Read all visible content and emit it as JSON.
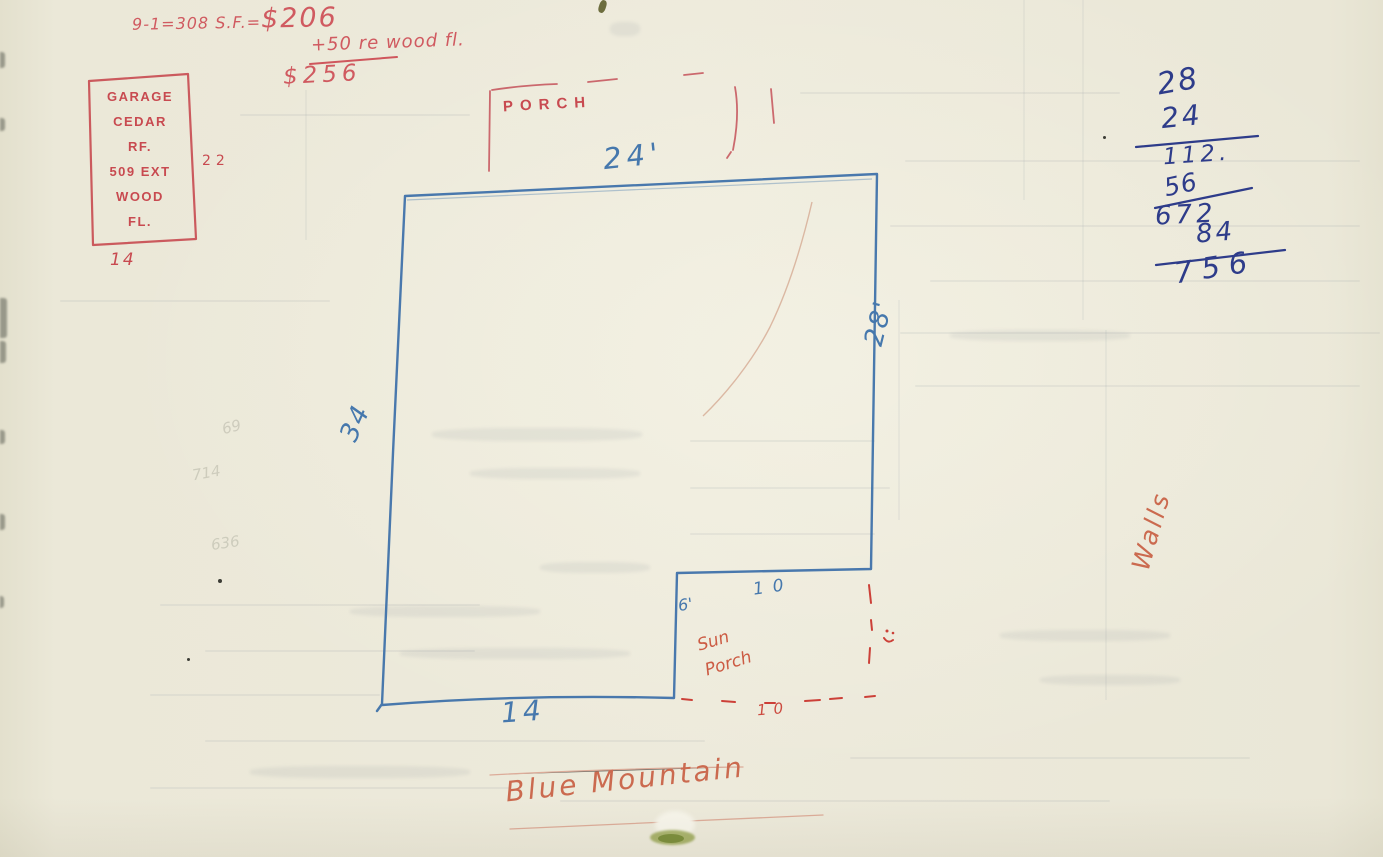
{
  "top_formula": {
    "equation_prefix": "9-1=308 S.F.=",
    "equation_value": "$206",
    "addition_line": "+50 re wood fl.",
    "total": "$256"
  },
  "garage_note": {
    "line1": "GARAGE",
    "line2": "CEDAR",
    "line3": "RF.",
    "line4": "509 EXT",
    "line5": "WOOD",
    "line6": "FL.",
    "width_dim": "22",
    "depth_dim": "14"
  },
  "floor_plan": {
    "porch_label": "PORCH",
    "top_dim": "24'",
    "right_dim": "28'",
    "left_dim": "34",
    "bottom_dim": "14",
    "notch_height_dim": "6'",
    "notch_top_dim": "10",
    "sun_porch_label": "Sun Porch",
    "sun_porch_bottom_dim": "10"
  },
  "wall_calc": {
    "label": "Walls",
    "rows": [
      "28",
      "24",
      "112.",
      "56",
      "672",
      "84",
      "756"
    ]
  },
  "footer": {
    "caption": "Blue Mountain"
  },
  "faint_pencil_marks": {
    "m1": "69",
    "m2": "714",
    "m3": "636"
  },
  "colors": {
    "paper": "#ebe8d8",
    "red_ink": "#c84a50",
    "orange_red_ink": "#cb6a4f",
    "blue_pencil": "#4678ad",
    "navy_ink": "#2e3c8a"
  }
}
